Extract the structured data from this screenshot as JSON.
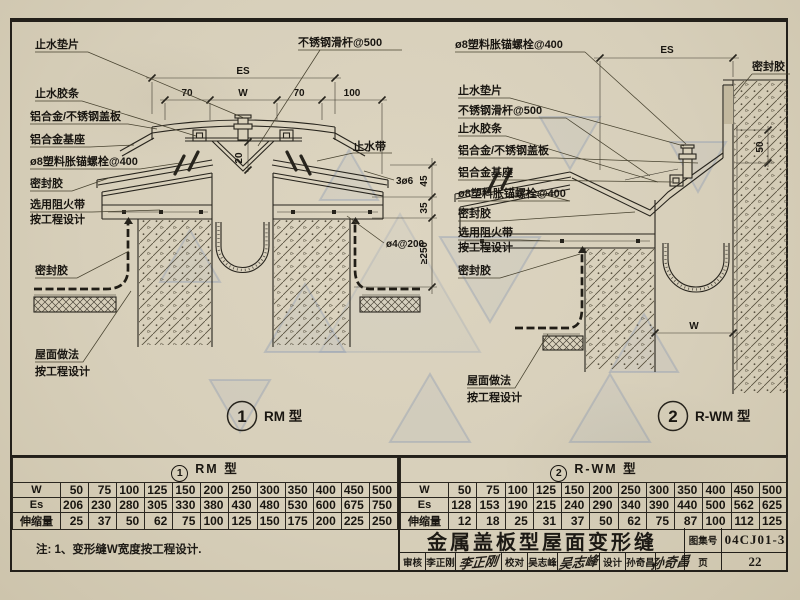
{
  "sheet": {
    "note": "注: 1、变形缝W宽度按工程设计.",
    "title": "金属盖板型屋面变形缝",
    "atlas_label": "图集号",
    "atlas_no": "04CJ01-3",
    "page_label": "页",
    "page_no": "22",
    "audit_label": "审核",
    "audit_name": "李正刚",
    "audit_sig": "李正刚",
    "check_label": "校对",
    "check_name": "吴志峰",
    "check_sig": "吴志峰",
    "design_label": "设计",
    "design_name": "孙奇昌",
    "design_sig": "孙奇昌"
  },
  "left_detail": {
    "caption_no": "1",
    "caption": "RM 型",
    "labels": {
      "gasket": "止水垫片",
      "slide_rod": "不锈钢滑杆@500",
      "rubber_strip": "止水胶条",
      "cover_plate": "铝合金/不锈钢盖板",
      "base": "铝合金基座",
      "anchor": "ø8塑料胀锚螺栓@400",
      "sealant1": "密封胶",
      "fire1": "选用阻火带",
      "fire2": "按工程设计",
      "waterstop": "止水带",
      "sealant2": "密封胶",
      "roof1": "屋面做法",
      "roof2": "按工程设计"
    },
    "dims": {
      "es": "ES",
      "a70": "70",
      "w": "W",
      "b70": "70",
      "c100": "100",
      "v20": "20",
      "r3d6": "3ø6",
      "v45": "45",
      "v35": "35",
      "v250": "≥250",
      "mesh": "ø4@200"
    }
  },
  "right_detail": {
    "caption_no": "2",
    "caption": "R-WM 型",
    "labels": {
      "anchor_top": "ø8塑料胀锚螺栓@400",
      "sealant_top": "密封胶",
      "gasket": "止水垫片",
      "slide_rod": "不锈钢滑杆@500",
      "rubber_strip": "止水胶条",
      "cover_plate": "铝合金/不锈钢盖板",
      "base": "铝合金基座",
      "anchor": "ø8塑料胀锚螺栓@400",
      "sealant1": "密封胶",
      "fire1": "选用阻火带",
      "fire2": "按工程设计",
      "sealant2": "密封胶",
      "roof1": "屋面做法",
      "roof2": "按工程设计"
    },
    "dims": {
      "es": "ES",
      "v50": "50",
      "w": "W"
    }
  },
  "tables": {
    "rm": {
      "no": "1",
      "title": "RM 型",
      "row_w_label": "W",
      "row_es_label": "Es",
      "row_ext_label": "伸缩量",
      "w": [
        "50",
        "75",
        "100",
        "125",
        "150",
        "200",
        "250",
        "300",
        "350",
        "400",
        "450",
        "500"
      ],
      "es": [
        "206",
        "230",
        "280",
        "305",
        "330",
        "380",
        "430",
        "480",
        "530",
        "600",
        "675",
        "750"
      ],
      "ext": [
        "25",
        "37",
        "50",
        "62",
        "75",
        "100",
        "125",
        "150",
        "175",
        "200",
        "225",
        "250"
      ]
    },
    "rwm": {
      "no": "2",
      "title": "R-WM 型",
      "row_w_label": "W",
      "row_es_label": "Es",
      "row_ext_label": "伸缩量",
      "w": [
        "50",
        "75",
        "100",
        "125",
        "150",
        "200",
        "250",
        "300",
        "350",
        "400",
        "450",
        "500"
      ],
      "es": [
        "128",
        "153",
        "190",
        "215",
        "240",
        "290",
        "340",
        "390",
        "440",
        "500",
        "562",
        "625"
      ],
      "ext": [
        "12",
        "18",
        "25",
        "31",
        "37",
        "50",
        "62",
        "75",
        "87",
        "100",
        "112",
        "125"
      ]
    }
  }
}
